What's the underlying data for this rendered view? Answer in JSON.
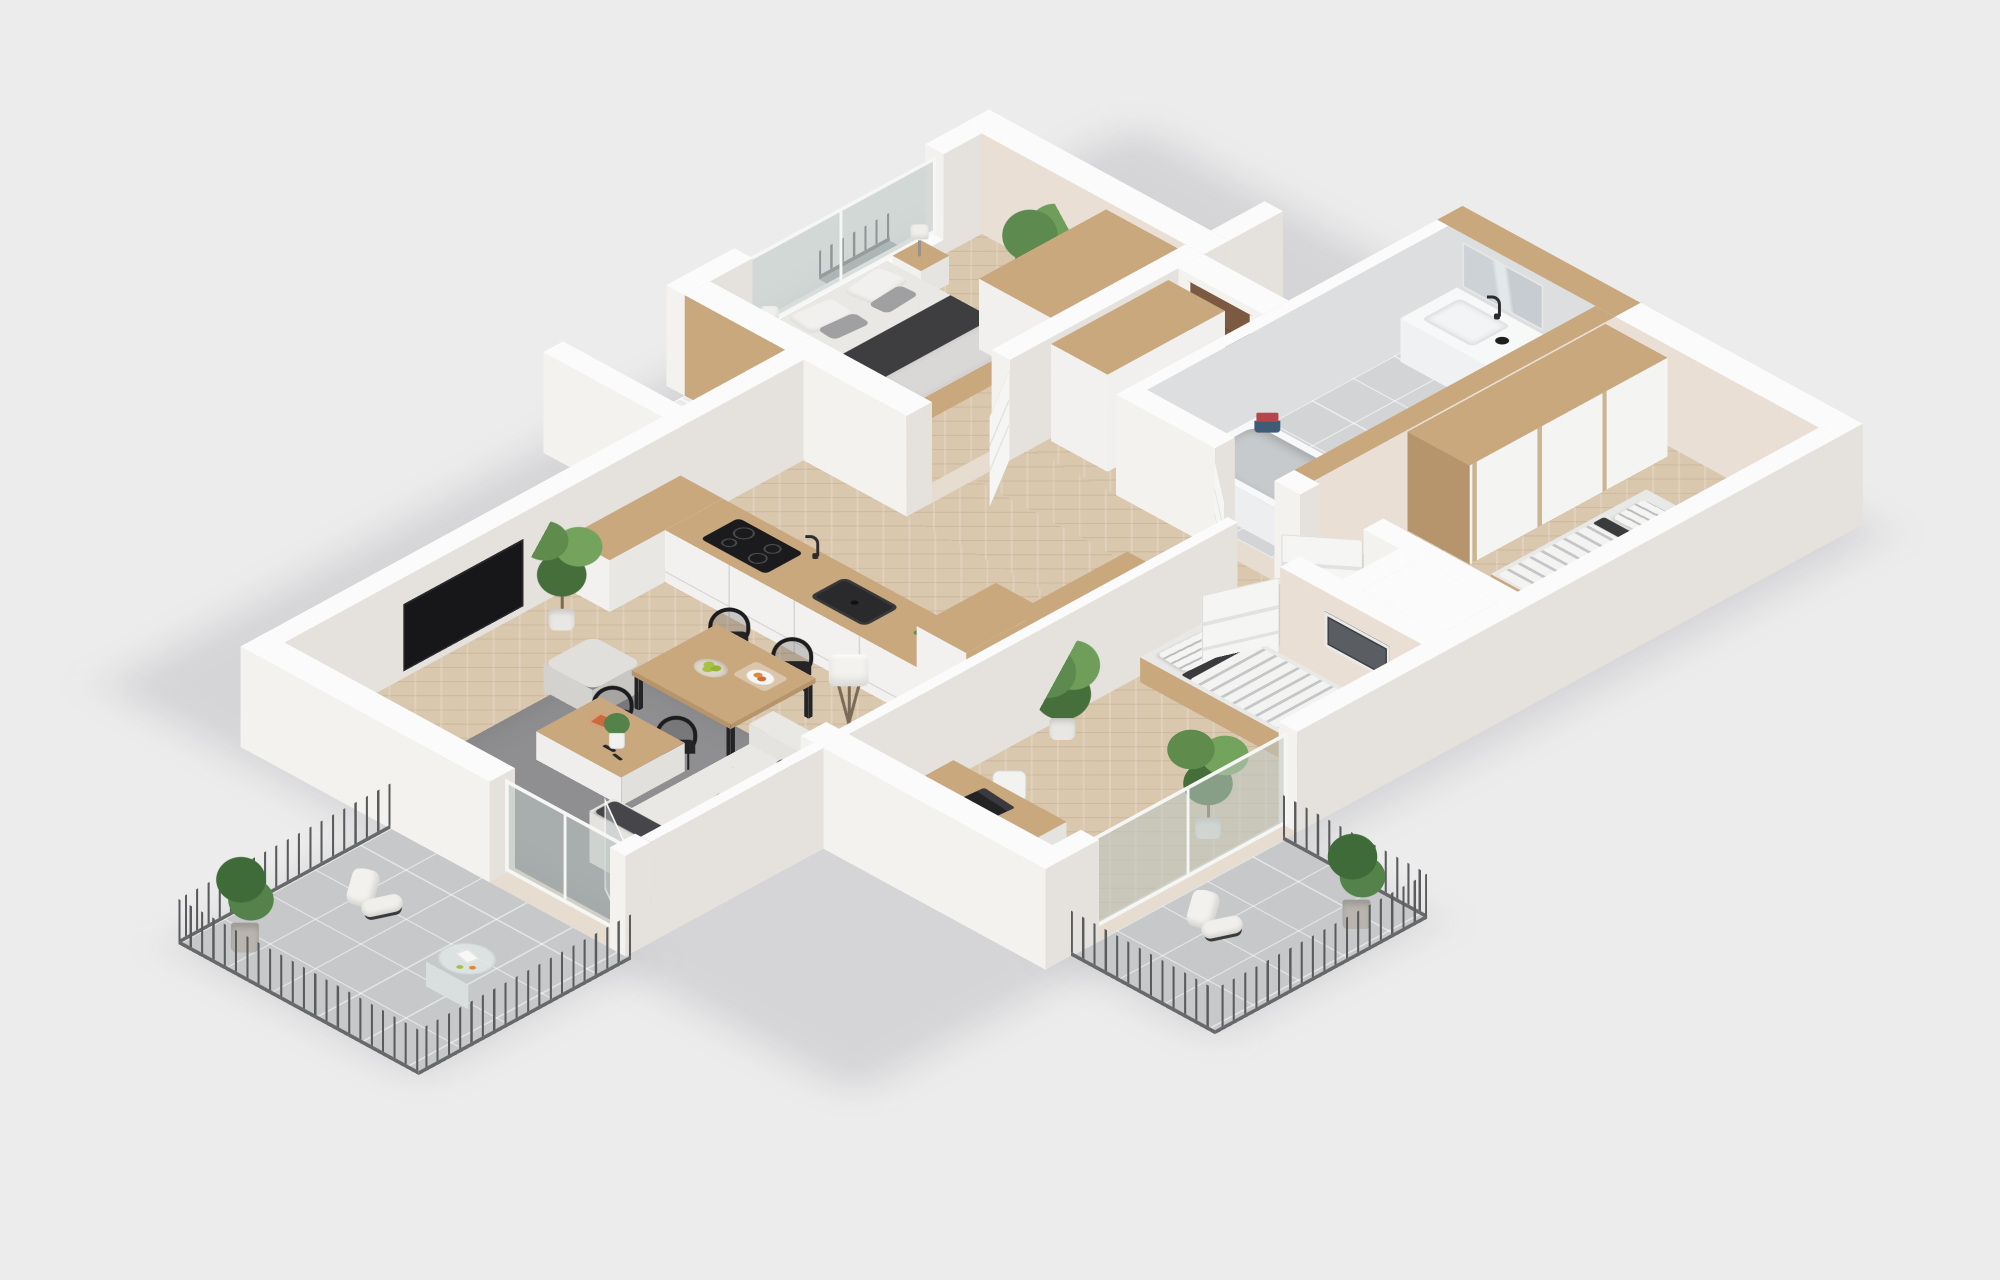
{
  "scene": {
    "kind": "isometric-3d-floor-plan-render",
    "description": "Photorealistic 3D cutaway floor plan of a three-bedroom apartment with two balconies, viewed isometrically on a plain light-gray background. No text labels are visible.",
    "background": "#ececec",
    "flooring": {
      "main": "light oak herringbone parquet",
      "bathroom": "gray tile",
      "storage": "white tile",
      "balconies": "gray tile"
    }
  },
  "palette": {
    "background": "#ececec",
    "wallTop": "#fbfbfb",
    "wallSouth": "#f4f2ef",
    "wallEast": "#e5e1dd",
    "wallBeige": "#eadfd4",
    "bathTileWall": "#dcdee0",
    "parquet": "#d9c7ae",
    "tileBath": "#d3d4d6",
    "tileBalcony": "#c6c8c9",
    "tileWhite": "#eaeaec",
    "wood": "#c9a87e",
    "woodDark": "#b6946c",
    "doorBrown": "#7b5a41",
    "sofa": "#e4e3e0",
    "sofaTop": "#e9e8e5",
    "sofaDark": "#d6d4d0",
    "rug": "#8f8f91",
    "dark": "#3c3c3e",
    "black": "#1b1b1d",
    "railing": "#5c5e60",
    "metal": "#9aa0a3",
    "mattress": "#e9e8e5",
    "quilt": "#d9d8d6",
    "glass": "rgba(188,198,195,0.55)",
    "frame": "#f6f6f5",
    "green1": "#5d8a4f",
    "green2": "#6f9e5b",
    "green3": "#466f3c",
    "apple": "#a6c23f",
    "towelRed": "#b8454a",
    "towelBlue": "#3f5c77",
    "bookOrange": "#c96b3a"
  },
  "rooms": [
    {
      "id": "master-bedroom",
      "label": "master bedroom",
      "furniture": [
        "double-bed with dark blanket and gray pillows",
        "two nightstands with lamps",
        "wardrobe with wood top",
        "potted plant",
        "west window",
        "exterior window ledge with railing"
      ]
    },
    {
      "id": "entry-hall",
      "label": "entry hall",
      "furniture": [
        "brown entrance door",
        "hall wardrobe"
      ]
    },
    {
      "id": "bathroom",
      "label": "bathroom",
      "furniture": [
        "bathtub",
        "vanity with basin and black faucet",
        "mirror",
        "red and blue towels"
      ]
    },
    {
      "id": "bedroom-2",
      "label": "bedroom 2",
      "furniture": [
        "single bed with striped bedding",
        "sliding-door wardrobe"
      ]
    },
    {
      "id": "bedroom-3",
      "label": "bedroom 3",
      "furniture": [
        "single bed with striped bedding",
        "desk with laptop",
        "office chair",
        "potted plants",
        "picture frame",
        "glass balcony door"
      ]
    },
    {
      "id": "kitchen",
      "label": "open kitchen",
      "furniture": [
        "counter with black sink and cooktop",
        "cutting board",
        "tall cabinet column",
        "dining table with fruit bowl and plate",
        "four black chairs"
      ]
    },
    {
      "id": "living-room",
      "label": "living room",
      "furniture": [
        "gray sofa with pillows",
        "gray rug",
        "wood coffee table with book and plant",
        "pouf",
        "floor lamp",
        "wall TV",
        "sideboard",
        "palm plant",
        "glass balcony doors"
      ]
    },
    {
      "id": "storage-closet",
      "label": "storage closet",
      "furniture": [
        "built-in wood wardrobe front"
      ]
    },
    {
      "id": "balcony-south",
      "label": "south balcony",
      "furniture": [
        "metal railing",
        "lounge chair",
        "round glass table with magazine",
        "fiddle-leaf plant"
      ]
    },
    {
      "id": "balcony-east",
      "label": "east balcony",
      "furniture": [
        "metal railing",
        "lounge chair",
        "fiddle-leaf plant"
      ]
    }
  ]
}
